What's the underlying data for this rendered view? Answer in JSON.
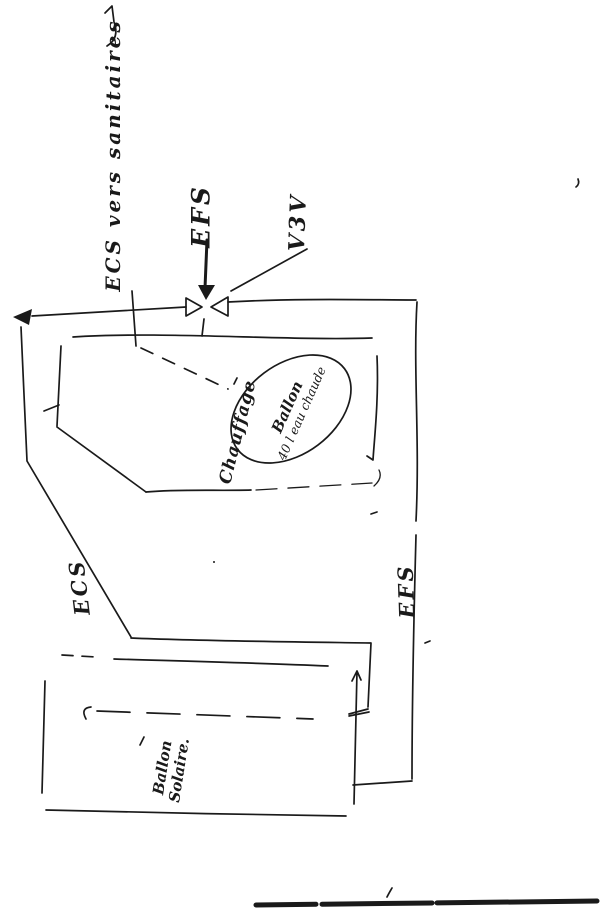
{
  "page": {
    "kind": "hand-drawn plumbing sketch (scanned)",
    "colors": {
      "paper": "#ffffff",
      "ink": "#1a1a1a"
    }
  },
  "labels": {
    "ecs_vers_sanitaires": "ECS vers sanitaires",
    "efs_supply": "EFS",
    "v3v_valve": "V3V",
    "ecs_line": "ECS",
    "efs_line": "EFS",
    "chauffage": "Chauffage",
    "hot_water_tank": {
      "line1": "Ballon",
      "line2": "40 l eau chaude"
    },
    "solar_tank": {
      "line1": "Ballon",
      "line2": "Solaire."
    }
  }
}
